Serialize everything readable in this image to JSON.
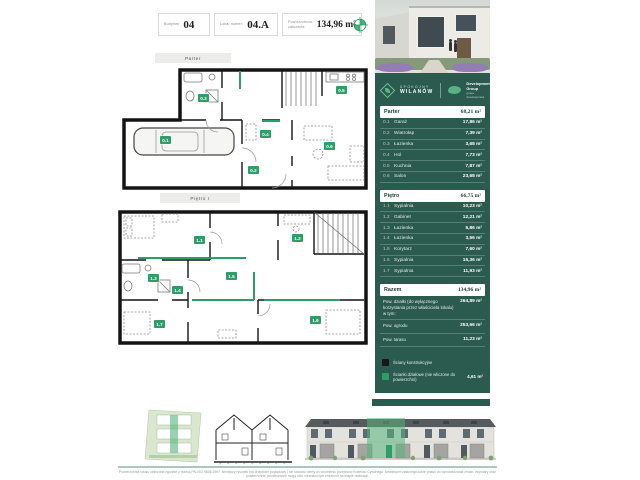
{
  "header": {
    "building_label": "Budynek",
    "building_value": "04",
    "unit_label": "Lokal numer:",
    "unit_value": "04.A",
    "area_label": "Powierzchnia całkowita",
    "area_value": "134,96 m²"
  },
  "branding": {
    "logo_line1": "SPOKOJNY",
    "logo_line2": "WILANÓW",
    "partner_name": "Development Group",
    "partner_sub": "grupa deweloperska"
  },
  "plans": {
    "parter_label": "Parter",
    "pietro_label": "Piętro I",
    "parter_badges": [
      {
        "label": "0.1",
        "x": 38,
        "y": 68
      },
      {
        "label": "0.2",
        "x": 126,
        "y": 98
      },
      {
        "label": "0.3",
        "x": 76,
        "y": 26
      },
      {
        "label": "0.4",
        "x": 138,
        "y": 62
      },
      {
        "label": "0.5",
        "x": 214,
        "y": 18
      },
      {
        "label": "0.6",
        "x": 202,
        "y": 74
      }
    ],
    "pietro_badges": [
      {
        "label": "1.1",
        "x": 76,
        "y": 26
      },
      {
        "label": "1.2",
        "x": 174,
        "y": 24
      },
      {
        "label": "1.3",
        "x": 30,
        "y": 64
      },
      {
        "label": "1.4",
        "x": 54,
        "y": 76
      },
      {
        "label": "1.5",
        "x": 108,
        "y": 62
      },
      {
        "label": "1.6",
        "x": 192,
        "y": 106
      },
      {
        "label": "1.7",
        "x": 36,
        "y": 110
      }
    ]
  },
  "floors": [
    {
      "name": "Parter",
      "total": "68,21 m²",
      "rooms": [
        {
          "no": "0.1",
          "name": "Garaż",
          "area": "17,86 m²"
        },
        {
          "no": "0.2",
          "name": "Wiatrołap",
          "area": "7,39 m²"
        },
        {
          "no": "0.3",
          "name": "Łazienka",
          "area": "3,68 m²"
        },
        {
          "no": "0.4",
          "name": "Hol",
          "area": "7,73 m²"
        },
        {
          "no": "0.5",
          "name": "Kuchnia",
          "area": "7,87 m²"
        },
        {
          "no": "0.6",
          "name": "Salon",
          "area": "23,68 m²"
        }
      ]
    },
    {
      "name": "Piętro",
      "total": "66,75 m²",
      "rooms": [
        {
          "no": "1.1",
          "name": "Sypialnia",
          "area": "10,23 m²"
        },
        {
          "no": "1.2",
          "name": "Gabinet",
          "area": "12,21 m²"
        },
        {
          "no": "1.3",
          "name": "Łazienka",
          "area": "5,86 m²"
        },
        {
          "no": "1.4",
          "name": "Łazienka",
          "area": "3,56 m²"
        },
        {
          "no": "1.5",
          "name": "Korytarz",
          "area": "7,60 m²"
        },
        {
          "no": "1.6",
          "name": "Sypialnia",
          "area": "15,36 m²"
        },
        {
          "no": "1.7",
          "name": "Sypialnia",
          "area": "11,93 m²"
        }
      ]
    }
  ],
  "summary": {
    "total_label": "Razem",
    "total_value": "134,96 m²",
    "extras": [
      {
        "label": "Pow. działki (do wyłącznego korzystania przez właściciela lokalu) w tym:",
        "value": "264,89 m²"
      },
      {
        "label": "Pow. ogrodu",
        "value": "253,66 m²"
      },
      {
        "label": "Pow. tarasu",
        "value": "11,23 m²"
      }
    ]
  },
  "legend": [
    {
      "color": "#161616",
      "label": "Ściany konstrukcyjne",
      "value": ""
    },
    {
      "color": "#2E9D68",
      "label": "Ścianki działowe (nie wliczone do powierzchni)",
      "value": "4,61 m²"
    }
  ],
  "footer": {
    "disclaimer": "Powierzchnia lokalu obliczona zgodnie z normą PN-ISO 9836:1997. Niniejszy rysunek ma charakter poglądowy i nie stanowi oferty w rozumieniu przepisów Kodeksu Cywilnego. Deweloper zastrzega sobie prawo do wprowadzania zmian. Wymiary oraz powierzchnie pomieszczeń mogą ulec nieznacznym zmianom na etapie realizacji."
  },
  "colors": {
    "panel_green": "#2B5A4E",
    "accent_green": "#2E9D68",
    "highlight_green": "#54B47A"
  }
}
